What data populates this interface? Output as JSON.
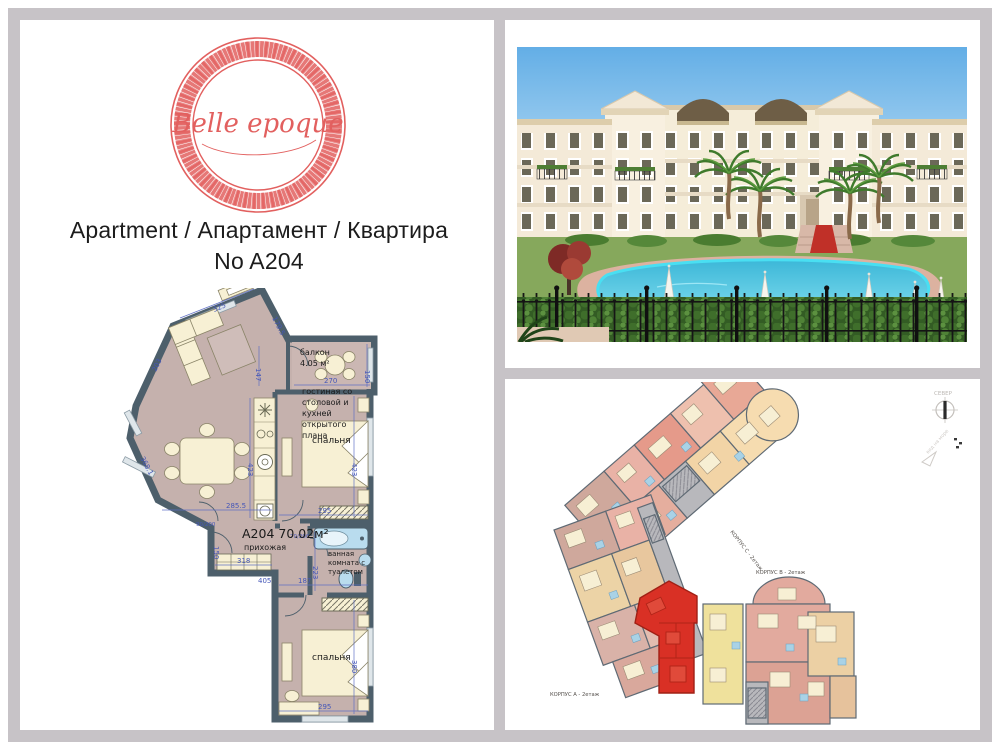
{
  "logo": {
    "brand": "Belle epoque",
    "color": "#e2605f"
  },
  "header": {
    "line1": "Apartment / Апартамент / Квартира",
    "line2": "No A204"
  },
  "floorplan": {
    "apartment_label": "A204 70.02м²",
    "rooms": {
      "living_lines": [
        "гостиная со",
        "столовой и",
        "кухней",
        "открытого",
        "плана"
      ],
      "balcony_lines": [
        "балкон",
        "4.05 м²"
      ],
      "bedroom1": "спальня",
      "bedroom2": "спальня",
      "hallway": "прихожая",
      "bath_lines": [
        "ванная",
        "комната с",
        "туалетом"
      ]
    },
    "dims": {
      "d325": "325",
      "d147": "147",
      "d1795": "179.5",
      "d270": "270",
      "d150b": "150",
      "d203": "203",
      "d368": "368.1",
      "d423k": "423",
      "d423b": "423",
      "d295b1": "295",
      "d2855": "285.5",
      "d318": "318",
      "d150h": "150",
      "d405": "405",
      "d187": "187",
      "d223": "223",
      "d295b2": "295",
      "d380": "380",
      "door1": "90/200",
      "door2": "70/200"
    },
    "wall_color": "#4d5f6b",
    "floor_color": "#c5b1ad",
    "dim_color": "#4f63c2"
  },
  "siteplan": {
    "north_label": "СЕВЕР",
    "view_label": "вид на море",
    "corpus_a": "КОРПУС А - 2етаж",
    "corpus_b": "КОРПУС В - 2етаж",
    "corpus_c": "КОРПУС С - 2етаж",
    "highlight_color": "#d93025"
  }
}
